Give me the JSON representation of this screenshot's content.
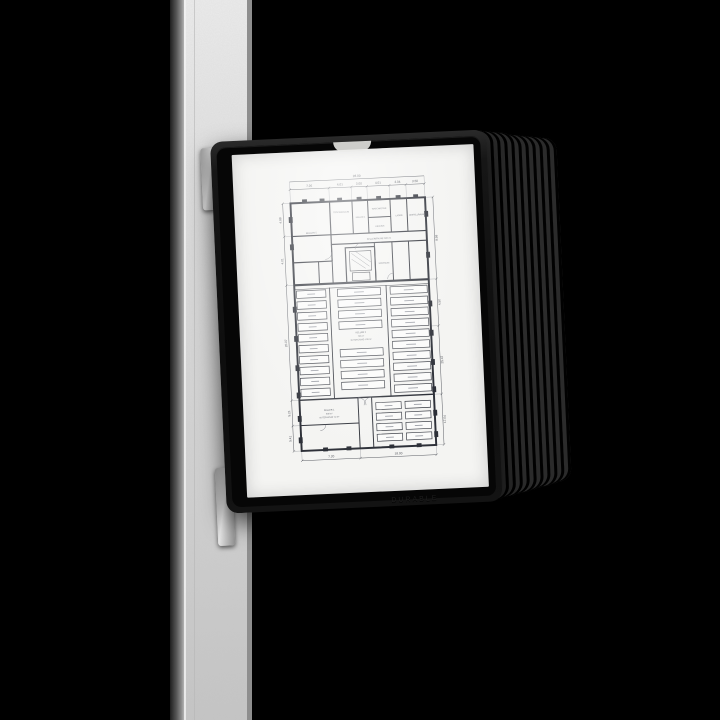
{
  "colors": {
    "background": "#000000",
    "panel_frame_black": "#141414",
    "post_galvanized_gray": "#cfcfcf",
    "paper_white": "#f4f4f2",
    "plan_line": "#2d3038"
  },
  "panel": {
    "brand_embossed": "DURABLE",
    "stack_panel_count": 10
  },
  "floor_plan": {
    "top_total": "28.00",
    "top_segments": [
      "7.26",
      "4.01",
      "3.00",
      "4.01",
      "3.04",
      "3.50"
    ],
    "bottom_segments": [
      "7.20",
      "18.00"
    ],
    "left_dims": [
      "4.88",
      "4.01",
      "20.07",
      "5.21",
      "5.41"
    ],
    "right_dims": [
      "8.98",
      "4.50",
      "25.47",
      "17.04"
    ],
    "rooms": {
      "keller5": "KELLER 5",
      "trockenraum": "TROCKENRAUM",
      "keller4": "KELLER 4",
      "waschkueche": "WASCHKÜCHE",
      "heizung": "HEIZUNG",
      "lager": "LAGER",
      "abstellraum": "ABSTELLRAUM",
      "heizraum": "HEIZRAUM",
      "corridor": "KELLERRÄUME 320 m²"
    },
    "keller2": [
      "KELLER 2",
      "720 m²",
      "NUTZFLÄCHE 4.28 m²"
    ],
    "keller1": [
      "KELLER 1",
      "630 m²",
      "NUTZFLÄCHE 7.2 m²"
    ]
  }
}
